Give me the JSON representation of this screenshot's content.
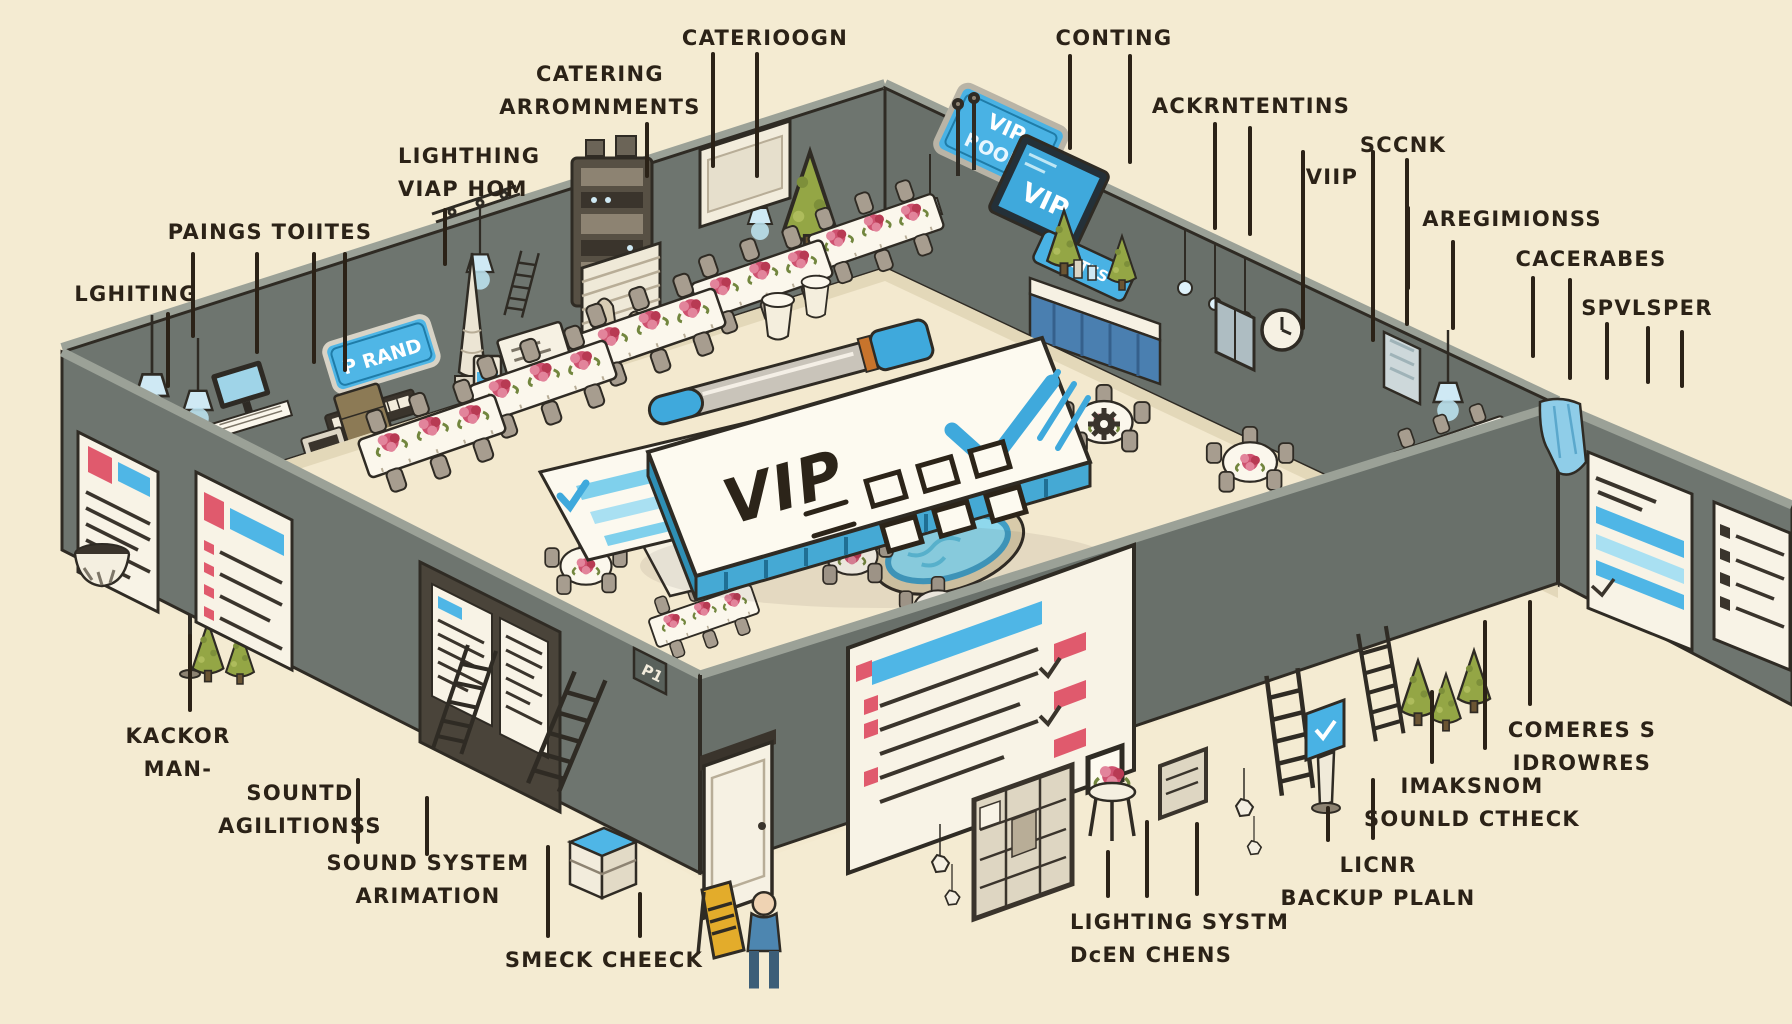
{
  "scene": {
    "description": "Hand-drawn isometric illustration of an event venue setup: banquet tables with flowers, AV equipment, wall checklist posters, ladders, a buffet, a small pool, and a giant VIP checklist clipboard with a pen, annotated with hand-lettered callout labels",
    "background": "#f4ebd2",
    "wall_color": "#6e756f",
    "floor_color": "#f3e9cf",
    "ink_color": "#2b2217",
    "accent_blue": "#45b3e0"
  },
  "signs": {
    "vip_room_line1": "VIP",
    "vip_room_line2": "ROOM",
    "vip_screen": "VIP",
    "stage_sign": "P RAND",
    "small_wall_sign": "LUTES",
    "clipboard_title": "VIP",
    "door_sign": "P1"
  },
  "callouts": [
    {
      "id": "catering-arrangements",
      "lines": [
        "CATERING",
        "ARROMNMENTS"
      ],
      "x": 600,
      "y": 58,
      "align": "center",
      "leaders": [
        [
          647,
          122,
          178
        ]
      ]
    },
    {
      "id": "cateriogn",
      "lines": [
        "CATERIOOGN"
      ],
      "x": 765,
      "y": 22,
      "align": "center",
      "leaders": [
        [
          713,
          52,
          168
        ],
        [
          757,
          52,
          178
        ]
      ]
    },
    {
      "id": "conting",
      "lines": [
        "CONTING"
      ],
      "x": 1114,
      "y": 22,
      "align": "center",
      "leaders": [
        [
          1070,
          54,
          150
        ],
        [
          1130,
          54,
          164
        ]
      ]
    },
    {
      "id": "ackrntentins",
      "lines": [
        "ACKRNTENTINS"
      ],
      "x": 1251,
      "y": 90,
      "align": "center",
      "leaders": [
        [
          1215,
          122,
          230
        ],
        [
          1250,
          126,
          236
        ]
      ]
    },
    {
      "id": "lighthing-viap-hom",
      "lines": [
        "LIGHTHING",
        "VIAP HOM"
      ],
      "x": 398,
      "y": 140,
      "align": "left",
      "leaders": [
        [
          445,
          208,
          266
        ]
      ]
    },
    {
      "id": "sccnk",
      "lines": [
        "SCCNK"
      ],
      "x": 1403,
      "y": 129,
      "align": "center",
      "leaders": [
        [
          1407,
          158,
          326
        ]
      ]
    },
    {
      "id": "viip",
      "lines": [
        "VIIP"
      ],
      "x": 1332,
      "y": 161,
      "align": "center",
      "leaders": [
        [
          1303,
          150,
          330
        ],
        [
          1373,
          150,
          342
        ]
      ]
    },
    {
      "id": "paings-toutes",
      "lines": [
        "PAINGS TOIITES"
      ],
      "x": 270,
      "y": 216,
      "align": "center",
      "leaders": [
        [
          193,
          252,
          338
        ],
        [
          257,
          252,
          354
        ],
        [
          314,
          252,
          364
        ],
        [
          345,
          252,
          372
        ]
      ]
    },
    {
      "id": "aregimionss",
      "lines": [
        "AREGIMIONSS"
      ],
      "x": 1512,
      "y": 203,
      "align": "center",
      "leaders": [
        [
          1408,
          206,
          290
        ],
        [
          1453,
          240,
          330
        ]
      ]
    },
    {
      "id": "cacerabes",
      "lines": [
        "CACERABES"
      ],
      "x": 1591,
      "y": 243,
      "align": "center",
      "leaders": [
        [
          1533,
          276,
          358
        ],
        [
          1570,
          278,
          380
        ]
      ]
    },
    {
      "id": "lghiting",
      "lines": [
        "LGHITING"
      ],
      "x": 136,
      "y": 278,
      "align": "center",
      "leaders": [
        [
          168,
          312,
          388
        ]
      ]
    },
    {
      "id": "spvlsper",
      "lines": [
        "SPVLSPER"
      ],
      "x": 1647,
      "y": 292,
      "align": "center",
      "leaders": [
        [
          1607,
          322,
          380
        ],
        [
          1648,
          326,
          384
        ],
        [
          1682,
          330,
          388
        ]
      ]
    },
    {
      "id": "kackor-man",
      "lines": [
        "KACKOR",
        "MAN-"
      ],
      "x": 178,
      "y": 720,
      "align": "center",
      "leaders": [
        [
          190,
          634,
          712
        ]
      ]
    },
    {
      "id": "sountd-agilitionss",
      "lines": [
        "SOUNTD",
        "AGILITIONSS"
      ],
      "x": 300,
      "y": 777,
      "align": "center",
      "leaders": [
        [
          358,
          778,
          844
        ],
        [
          427,
          796,
          856
        ]
      ]
    },
    {
      "id": "sound-system-arimation",
      "lines": [
        "SOUND SYSTEM",
        "ARIMATION"
      ],
      "x": 428,
      "y": 847,
      "align": "center",
      "leaders": [
        [
          548,
          845,
          938
        ]
      ]
    },
    {
      "id": "smeck-cheeck",
      "lines": [
        "SMECK CHEECK"
      ],
      "x": 604,
      "y": 944,
      "align": "center",
      "leaders": [
        [
          640,
          892,
          938
        ]
      ]
    },
    {
      "id": "lighting-systm-dcen-chens",
      "lines": [
        "LIGHTING SYSTM",
        "DcEN CHENS"
      ],
      "x": 1070,
      "y": 906,
      "align": "left",
      "leaders": [
        [
          1108,
          850,
          898
        ],
        [
          1147,
          820,
          898
        ],
        [
          1197,
          822,
          896
        ]
      ]
    },
    {
      "id": "licnr-backup-plaln",
      "lines": [
        "LICNR",
        "BACKUP PLALN"
      ],
      "x": 1378,
      "y": 849,
      "align": "center",
      "leaders": [
        [
          1328,
          806,
          842
        ],
        [
          1373,
          778,
          840
        ]
      ]
    },
    {
      "id": "imaksnom-sounld-ctheck",
      "lines": [
        "IMAKSNOM",
        "SOUNLD CTHECK"
      ],
      "x": 1472,
      "y": 770,
      "align": "center",
      "leaders": [
        [
          1432,
          690,
          764
        ],
        [
          1485,
          620,
          750
        ]
      ]
    },
    {
      "id": "comeres-idrowres",
      "lines": [
        "COMERES S",
        "IDROWRES"
      ],
      "x": 1582,
      "y": 714,
      "align": "center",
      "leaders": [
        [
          1530,
          600,
          706
        ]
      ]
    }
  ]
}
